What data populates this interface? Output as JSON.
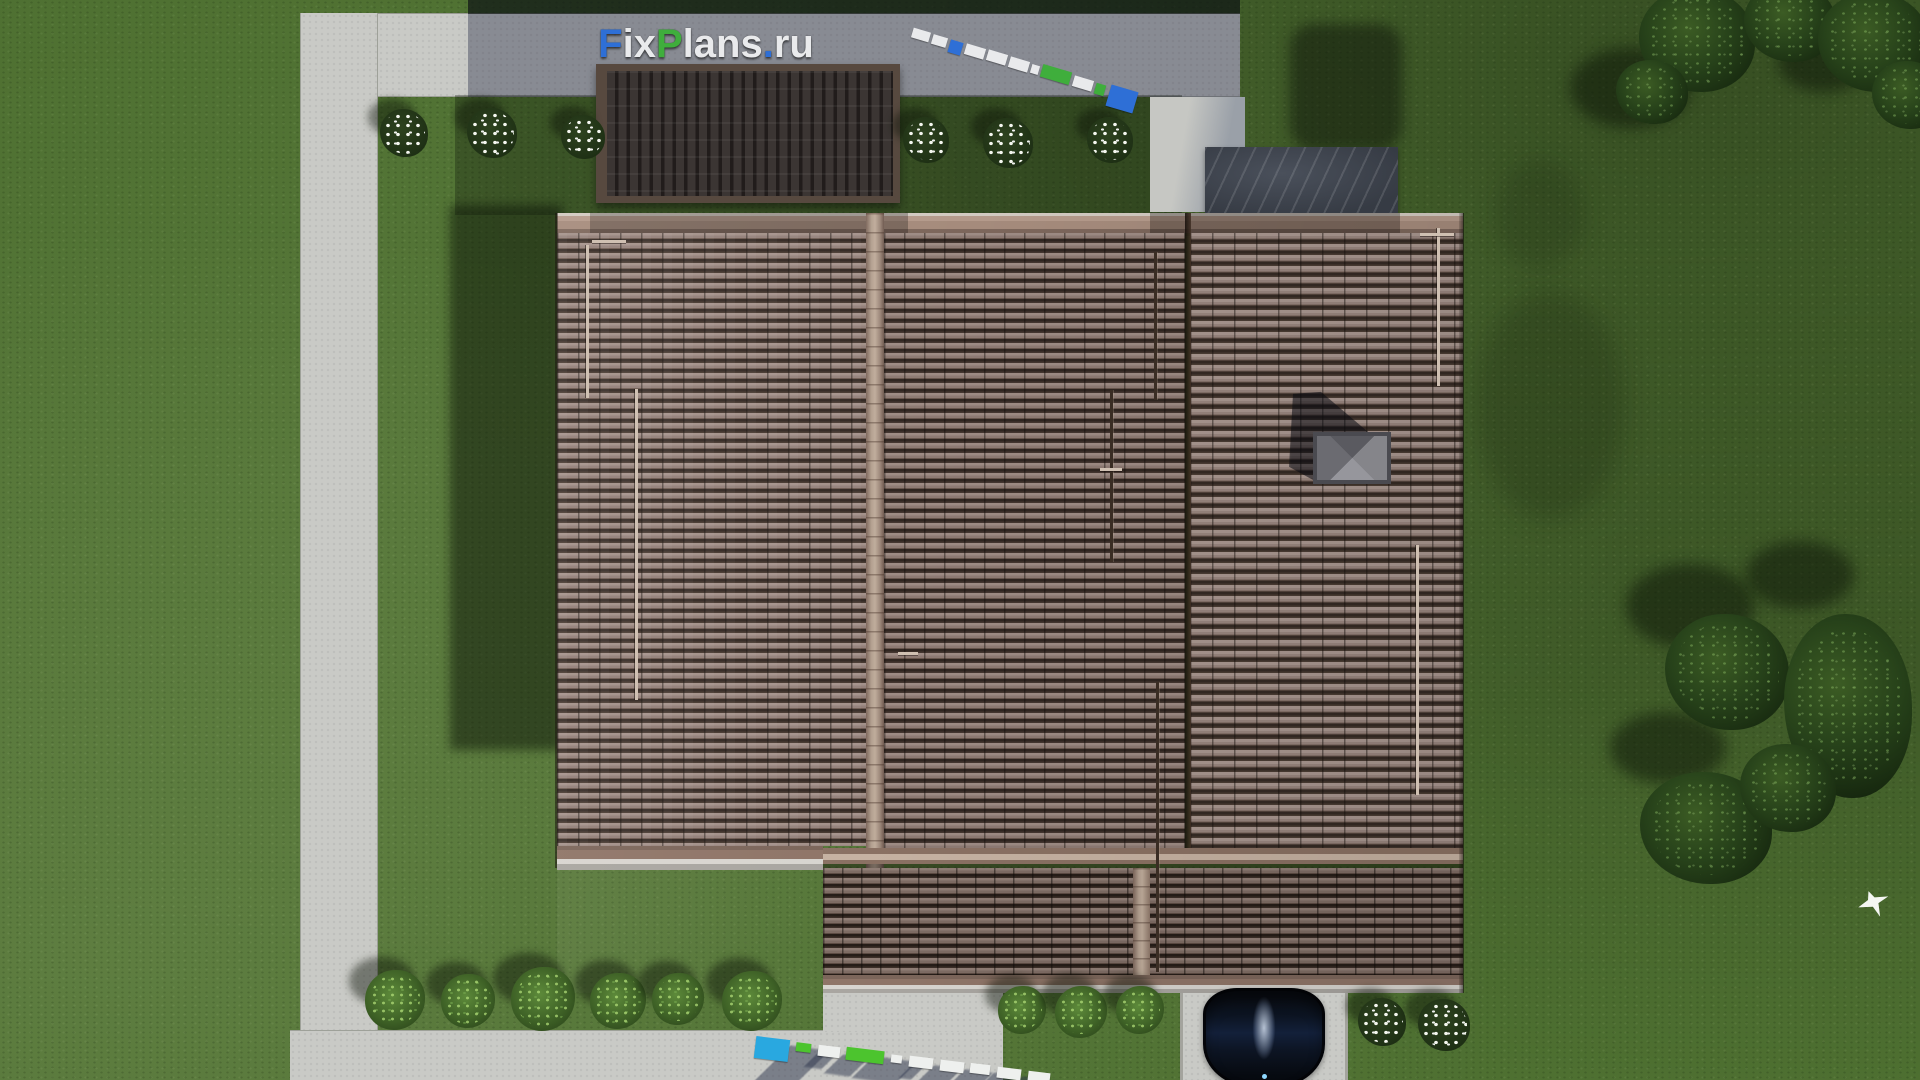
{
  "brand": {
    "name": "FixPlans.ru",
    "segments": [
      {
        "text": "F",
        "color": "#2e6fd6"
      },
      {
        "text": "ix",
        "color": "#e9eaec"
      },
      {
        "text": "P",
        "color": "#3fae3c"
      },
      {
        "text": "lans",
        "color": "#e9eaec"
      },
      {
        "text": ".",
        "color": "#2e6fd6"
      },
      {
        "text": "ru",
        "color": "#e9eaec"
      }
    ]
  },
  "scene": {
    "description": "Top-down aerial 3D render of a house plot with brown tiled hip roof, concrete walkways, lawn, trees, bushes, a parked black car and FixPlans.ru 3D watermarks",
    "objects": [
      "lawn",
      "concrete-walkways",
      "dark-pergola-roof",
      "stone-terrace",
      "main-tiled-roof",
      "porch-roof",
      "chimney-cap",
      "black-car",
      "driveway",
      "flower-bushes",
      "green-bushes",
      "trees",
      "white-bird"
    ]
  },
  "palette": {
    "lawn": "#4e7031",
    "lawn_dark": "#3c5a26",
    "concrete": "#c9cac6",
    "concrete_shadow": "#8f939e",
    "roof_tile_light": "#a29089",
    "roof_tile_gap": "#2f2520",
    "ridge_cap": "#b3a090",
    "gutter": "#d8d5d0",
    "pergola_dark": "#3b3533",
    "marble_deck": "#3e434d",
    "chimney_gray": "#85858a",
    "car_body": "#0c1422",
    "logo_blue": "#2e6fd6",
    "logo_green": "#3fae3c",
    "logo_white": "#e9eaec"
  },
  "watermarks": {
    "top": {
      "x": 912,
      "y": 30,
      "angle_deg": 16.5,
      "gap": 3,
      "blocks": [
        {
          "w": 18,
          "h": 10,
          "c": "#e9eaec"
        },
        {
          "w": 15,
          "h": 10,
          "c": "#e9eaec"
        },
        {
          "w": 13,
          "h": 13,
          "c": "#2e6fd6"
        },
        {
          "w": 20,
          "h": 11,
          "c": "#e9eaec"
        },
        {
          "w": 20,
          "h": 11,
          "c": "#e9eaec"
        },
        {
          "w": 20,
          "h": 11,
          "c": "#e9eaec"
        },
        {
          "w": 8,
          "h": 9,
          "c": "#e9eaec"
        },
        {
          "w": 30,
          "h": 13,
          "c": "#3fae3c"
        },
        {
          "w": 20,
          "h": 11,
          "c": "#e9eaec"
        },
        {
          "w": 10,
          "h": 11,
          "c": "#3fae3c"
        },
        {
          "w": 28,
          "h": 22,
          "c": "#2e6fd6"
        }
      ],
      "shadows": false
    },
    "bottom": {
      "x": 755,
      "y": 1038,
      "angle_deg": 7,
      "gap": 7,
      "blocks": [
        {
          "w": 34,
          "h": 22,
          "c": "#29a8e0"
        },
        {
          "w": 15,
          "h": 9,
          "c": "#4cc42e"
        },
        {
          "w": 22,
          "h": 11,
          "c": "#eef0ee"
        },
        {
          "w": 38,
          "h": 13,
          "c": "#4cc42e"
        },
        {
          "w": 11,
          "h": 8,
          "c": "#eef0ee"
        },
        {
          "w": 24,
          "h": 11,
          "c": "#eef0ee"
        },
        {
          "w": 24,
          "h": 11,
          "c": "#eef0ee"
        },
        {
          "w": 20,
          "h": 10,
          "c": "#eef0ee"
        },
        {
          "w": 24,
          "h": 11,
          "c": "#eef0ee"
        },
        {
          "w": 22,
          "h": 10,
          "c": "#eef0ee"
        }
      ],
      "shadows": true
    }
  },
  "roof_details": {
    "rails": [
      {
        "x": 586,
        "y1": 245,
        "y2": 398,
        "tone": "light"
      },
      {
        "x": 635,
        "y1": 389,
        "y2": 700,
        "tone": "light"
      },
      {
        "x": 1110,
        "y1": 390,
        "y2": 562,
        "tone": "dark"
      },
      {
        "x": 1154,
        "y1": 252,
        "y2": 400,
        "tone": "dark"
      },
      {
        "x": 1156,
        "y1": 682,
        "y2": 972,
        "tone": "dark"
      },
      {
        "x": 1437,
        "y1": 228,
        "y2": 386,
        "tone": "light"
      },
      {
        "x": 1416,
        "y1": 545,
        "y2": 795,
        "tone": "light"
      }
    ],
    "snow_guards": [
      {
        "x": 592,
        "y": 240,
        "w": 34
      },
      {
        "x": 1420,
        "y": 233,
        "w": 34
      },
      {
        "x": 1100,
        "y": 468,
        "w": 22
      },
      {
        "x": 898,
        "y": 652,
        "w": 20
      }
    ]
  },
  "vegetation": {
    "flower_bushes": [
      {
        "x": 404,
        "y": 133,
        "r": 24
      },
      {
        "x": 492,
        "y": 133,
        "r": 25
      },
      {
        "x": 583,
        "y": 137,
        "r": 22
      },
      {
        "x": 926,
        "y": 140,
        "r": 23
      },
      {
        "x": 1008,
        "y": 143,
        "r": 25
      },
      {
        "x": 1110,
        "y": 140,
        "r": 23
      },
      {
        "x": 1382,
        "y": 1022,
        "r": 24
      },
      {
        "x": 1444,
        "y": 1025,
        "r": 26
      }
    ],
    "green_bushes": [
      {
        "x": 395,
        "y": 1000,
        "r": 30
      },
      {
        "x": 468,
        "y": 1001,
        "r": 27
      },
      {
        "x": 543,
        "y": 999,
        "r": 32
      },
      {
        "x": 618,
        "y": 1001,
        "r": 28
      },
      {
        "x": 678,
        "y": 999,
        "r": 26
      },
      {
        "x": 752,
        "y": 1001,
        "r": 30
      },
      {
        "x": 1022,
        "y": 1010,
        "r": 24
      },
      {
        "x": 1081,
        "y": 1012,
        "r": 26
      },
      {
        "x": 1140,
        "y": 1010,
        "r": 24
      }
    ],
    "trees": [
      {
        "x": 1697,
        "y": 40,
        "rx": 58,
        "ry": 52
      },
      {
        "x": 1652,
        "y": 92,
        "rx": 36,
        "ry": 32
      },
      {
        "x": 1790,
        "y": 22,
        "rx": 46,
        "ry": 40
      },
      {
        "x": 1874,
        "y": 42,
        "rx": 56,
        "ry": 50
      },
      {
        "x": 1908,
        "y": 95,
        "rx": 36,
        "ry": 34
      },
      {
        "x": 1727,
        "y": 672,
        "rx": 62,
        "ry": 58
      },
      {
        "x": 1848,
        "y": 706,
        "rx": 64,
        "ry": 92
      },
      {
        "x": 1706,
        "y": 828,
        "rx": 66,
        "ry": 56
      },
      {
        "x": 1788,
        "y": 788,
        "rx": 48,
        "ry": 44
      }
    ],
    "tree_shadows": [
      {
        "x": 1630,
        "y": 88,
        "rx": 60,
        "ry": 40
      },
      {
        "x": 1824,
        "y": 62,
        "rx": 46,
        "ry": 30
      },
      {
        "x": 1690,
        "y": 606,
        "rx": 64,
        "ry": 42
      },
      {
        "x": 1800,
        "y": 575,
        "rx": 54,
        "ry": 34
      },
      {
        "x": 1668,
        "y": 748,
        "rx": 58,
        "ry": 36
      }
    ]
  }
}
